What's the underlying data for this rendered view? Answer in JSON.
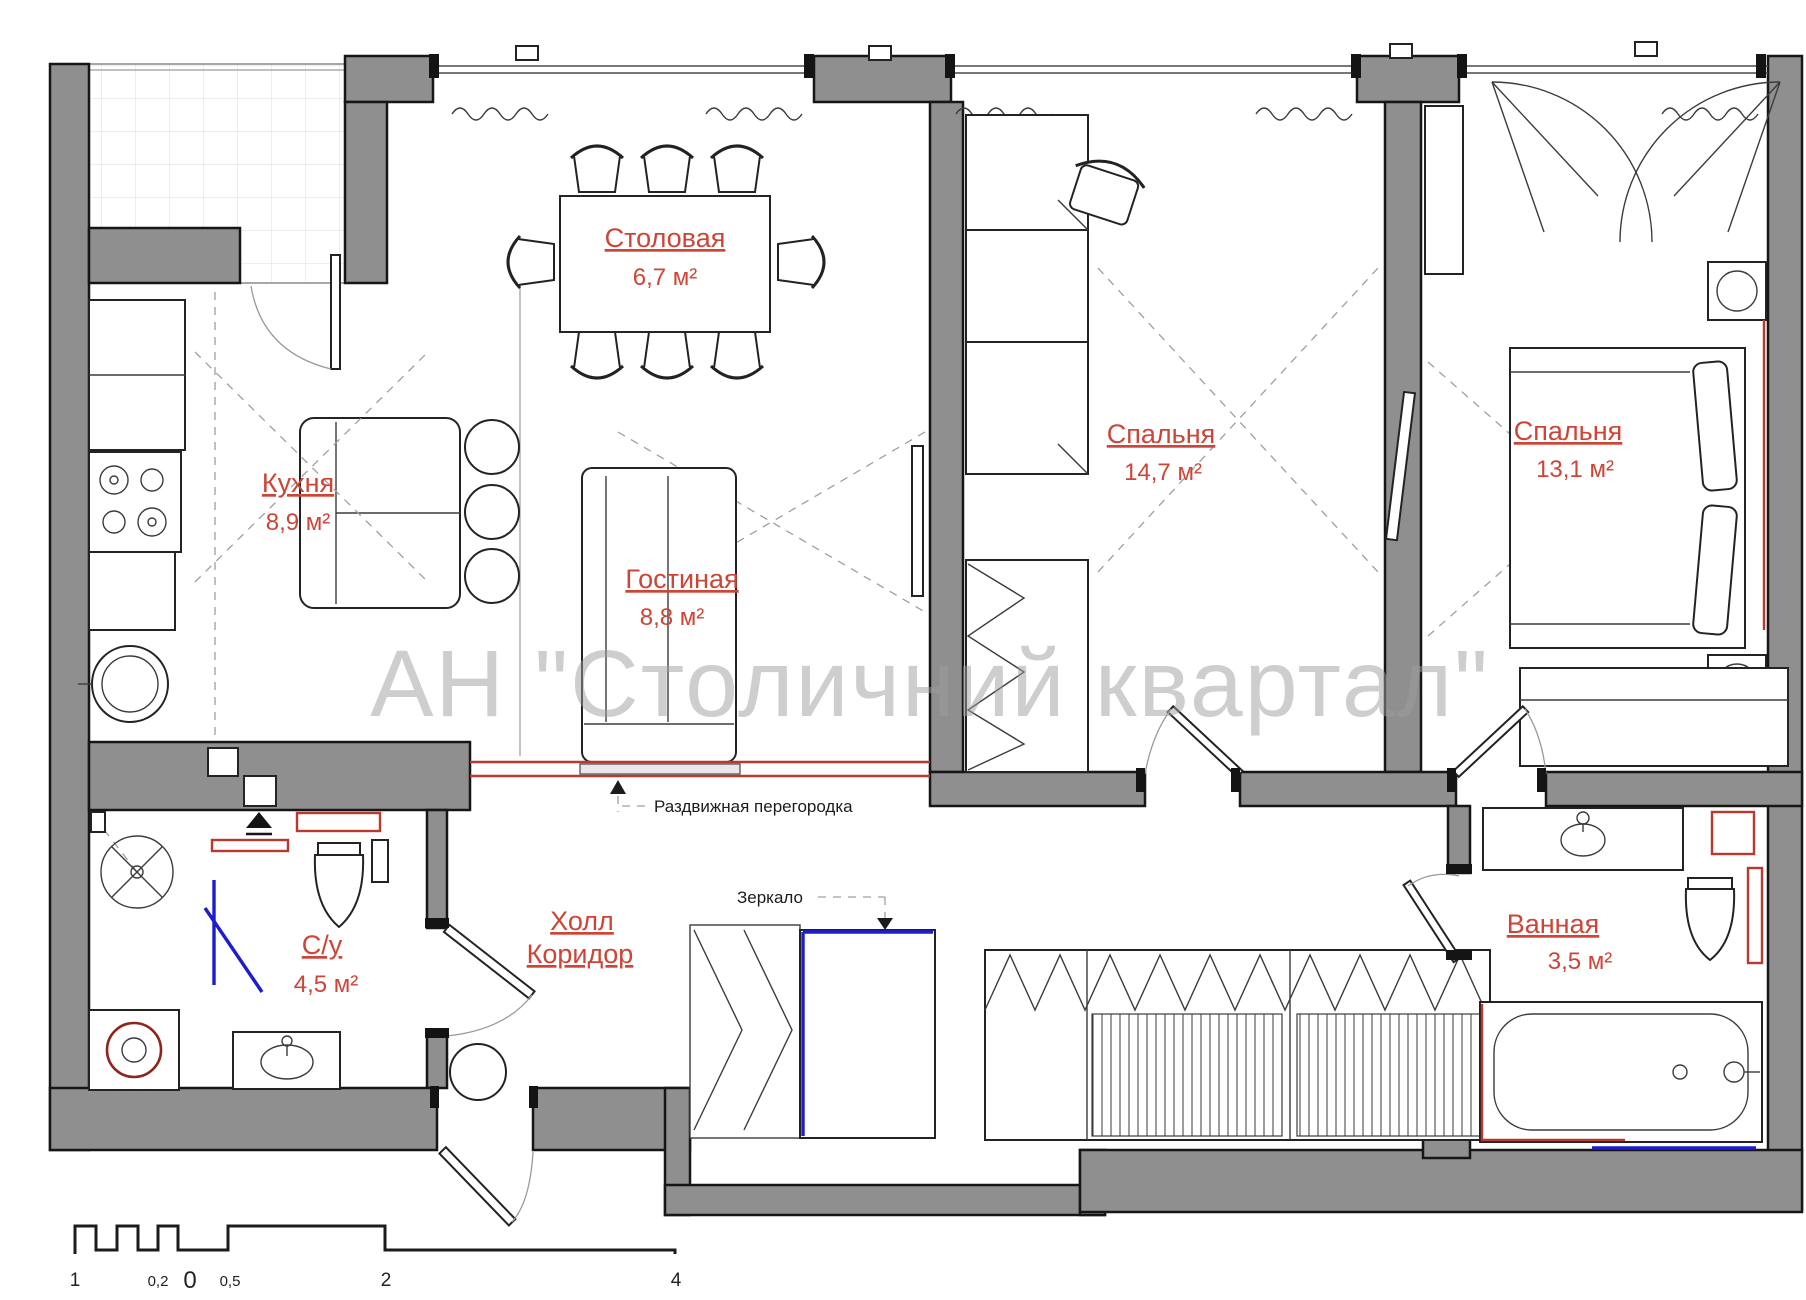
{
  "watermark": {
    "text": "АН \"Столичний квартал\""
  },
  "rooms": [
    {
      "id": "dining",
      "name": "Столовая",
      "area": "6,7 м²"
    },
    {
      "id": "kitchen",
      "name": "Кухня",
      "area": "8,9 м²"
    },
    {
      "id": "living",
      "name": "Гостиная",
      "area": "8,8 м²"
    },
    {
      "id": "bedroom1",
      "name": "Спальня",
      "area": "14,7 м²"
    },
    {
      "id": "bedroom2",
      "name": "Спальня",
      "area": "13,1 м²"
    },
    {
      "id": "wc",
      "name": "С/у",
      "area": "4,5 м²"
    },
    {
      "id": "hall",
      "line1": "Холл",
      "line2": "Коридор"
    },
    {
      "id": "bath",
      "name": "Ванная",
      "area": "3,5 м²"
    }
  ],
  "annotations": {
    "partition": "Раздвижная перегородка",
    "mirror": "Зеркало"
  },
  "scale_bar": {
    "labels": [
      "1",
      "0,2",
      "0",
      "0,5",
      "2",
      "4"
    ]
  },
  "colors": {
    "wall_gray": "#8f8f8f",
    "label_red": "#cd4537",
    "mirror_blue": "#1d1dcf",
    "watermark_gray": "#9e9e9e"
  }
}
